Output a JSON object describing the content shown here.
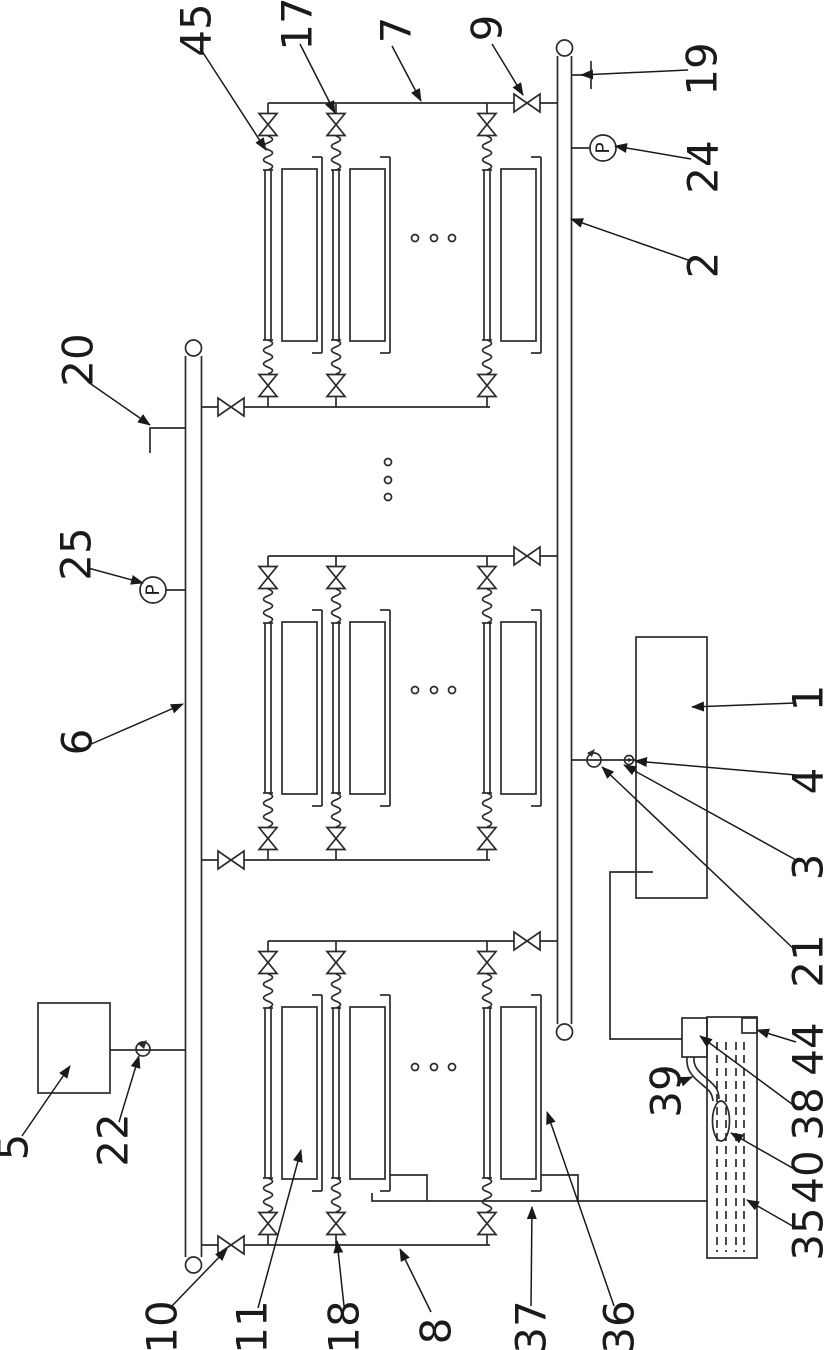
{
  "figure": {
    "kind": "patent-style piping schematic, rotated 90 degrees (labels read bottom-to-top)",
    "background_color": "#ffffff",
    "line_color": "#2b2b2b",
    "label_color": "#1a1a1a"
  },
  "gauges": [
    {
      "letter": "P",
      "cx": 603,
      "cy": 148,
      "name": "pressure-gauge-24"
    },
    {
      "letter": "P",
      "cx": 153,
      "cy": 590,
      "name": "pressure-gauge-25"
    }
  ],
  "reference_labels": [
    {
      "text": "45",
      "x": 196,
      "y": 30,
      "leader": [
        200,
        48,
        266,
        150
      ],
      "target": "flex-hose-module1-branch1"
    },
    {
      "text": "17",
      "x": 297,
      "y": 24,
      "leader": [
        300,
        44,
        335,
        113
      ],
      "target": "branch-valve-module1-branch2"
    },
    {
      "text": "7",
      "x": 396,
      "y": 30,
      "leader": [
        392,
        46,
        421,
        101
      ],
      "target": "top-manifold-module1"
    },
    {
      "text": "9",
      "x": 487,
      "y": 28,
      "leader": [
        492,
        44,
        523,
        95
      ],
      "target": "manifold-isolation-valve-module1"
    },
    {
      "text": "19",
      "x": 702,
      "y": 69,
      "leader": [
        688,
        70,
        581,
        75
      ],
      "target": "capped-port-pipe2"
    },
    {
      "text": "24",
      "x": 703,
      "y": 167,
      "leader": [
        691,
        159,
        615,
        146
      ],
      "target": "pressure-gauge-24"
    },
    {
      "text": "2",
      "x": 703,
      "y": 265,
      "leader": [
        691,
        261,
        571,
        219
      ],
      "target": "collection-pipe-2"
    },
    {
      "text": "20",
      "x": 78,
      "y": 360,
      "leader": [
        88,
        382,
        150,
        425
      ],
      "target": "capped-port-pipe6"
    },
    {
      "text": "25",
      "x": 76,
      "y": 554,
      "leader": [
        88,
        568,
        143,
        583
      ],
      "target": "pressure-gauge-25"
    },
    {
      "text": "6",
      "x": 77,
      "y": 742,
      "leader": [
        89,
        745,
        183,
        704
      ],
      "target": "feed-pipe-6"
    },
    {
      "text": "5",
      "x": 13,
      "y": 1147,
      "leader": [
        22,
        1136,
        70,
        1066
      ],
      "target": "box-5"
    },
    {
      "text": "22",
      "x": 113,
      "y": 1140,
      "leader": [
        119,
        1122,
        139,
        1056
      ],
      "target": "valve-22"
    },
    {
      "text": "10",
      "x": 162,
      "y": 1327,
      "leader": [
        170,
        1308,
        227,
        1249
      ],
      "target": "manifold-valve-10"
    },
    {
      "text": "11",
      "x": 252,
      "y": 1327,
      "leader": [
        258,
        1308,
        301,
        1150
      ],
      "target": "filter-plate-module3-branch1"
    },
    {
      "text": "18",
      "x": 344,
      "y": 1327,
      "leader": [
        344,
        1306,
        337,
        1241
      ],
      "target": "branch-valve-module3-branch2"
    },
    {
      "text": "8",
      "x": 436,
      "y": 1331,
      "leader": [
        431,
        1312,
        400,
        1249
      ],
      "target": "bottom-manifold-module3"
    },
    {
      "text": "37",
      "x": 531,
      "y": 1327,
      "leader": [
        531,
        1306,
        532,
        1207
      ],
      "target": "drain-line"
    },
    {
      "text": "36",
      "x": 619,
      "y": 1327,
      "leader": [
        614,
        1306,
        547,
        1112
      ],
      "target": "support-bracket-module3-branch3"
    },
    {
      "text": "35",
      "x": 808,
      "y": 1234,
      "leader": [
        796,
        1228,
        747,
        1200
      ],
      "target": "tank-35"
    },
    {
      "text": "40",
      "x": 808,
      "y": 1177,
      "leader": [
        796,
        1170,
        731,
        1133
      ],
      "target": "submersible-pump-40"
    },
    {
      "text": "38",
      "x": 808,
      "y": 1114,
      "leader": [
        796,
        1107,
        700,
        1036
      ],
      "target": "pump-box-38"
    },
    {
      "text": "44",
      "x": 808,
      "y": 1049,
      "leader": [
        796,
        1042,
        757,
        1030
      ],
      "target": "overflow-port-44"
    },
    {
      "text": "39",
      "x": 666,
      "y": 1091,
      "leader": [
        678,
        1083,
        692,
        1077
      ],
      "target": "hose-39"
    },
    {
      "text": "21",
      "x": 808,
      "y": 961,
      "leader": [
        796,
        951,
        602,
        767
      ],
      "target": "fitting-a-on-box1-line"
    },
    {
      "text": "3",
      "x": 808,
      "y": 867,
      "leader": [
        796,
        860,
        624,
        765
      ],
      "target": "fitting-connection-line"
    },
    {
      "text": "4",
      "x": 808,
      "y": 781,
      "leader": [
        796,
        775,
        635,
        761
      ],
      "target": "fitting-b-on-box1-line"
    },
    {
      "text": "1",
      "x": 808,
      "y": 698,
      "leader": [
        796,
        703,
        692,
        707
      ],
      "target": "box-1"
    }
  ]
}
